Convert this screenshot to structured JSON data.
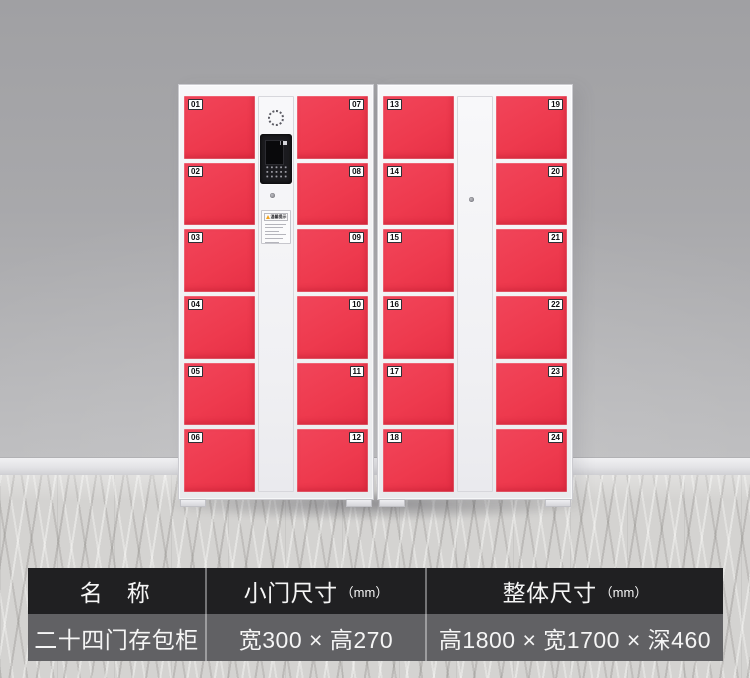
{
  "scene": {
    "wall_color": "#a8a8ab",
    "floor_color": "#d4d3d1",
    "cabinet_color": "#f3f3f5",
    "door_color": "#ee3a4e"
  },
  "product": {
    "cabinets": [
      {
        "type": "control",
        "left_doors": [
          "01",
          "02",
          "03",
          "04",
          "05",
          "06"
        ],
        "right_doors": [
          "07",
          "08",
          "09",
          "10",
          "11",
          "12"
        ],
        "sticker_title": "温馨提示"
      },
      {
        "type": "plain",
        "left_doors": [
          "13",
          "14",
          "15",
          "16",
          "17",
          "18"
        ],
        "right_doors": [
          "19",
          "20",
          "21",
          "22",
          "23",
          "24"
        ]
      }
    ]
  },
  "spec_table": {
    "headers": [
      {
        "label": "名　称",
        "unit": ""
      },
      {
        "label": "小门尺寸",
        "unit": "（mm）"
      },
      {
        "label": "整体尺寸",
        "unit": "（mm）"
      }
    ],
    "values": [
      "二十四门存包柜",
      "宽300 × 高270",
      "高1800 × 宽1700 × 深460"
    ]
  }
}
